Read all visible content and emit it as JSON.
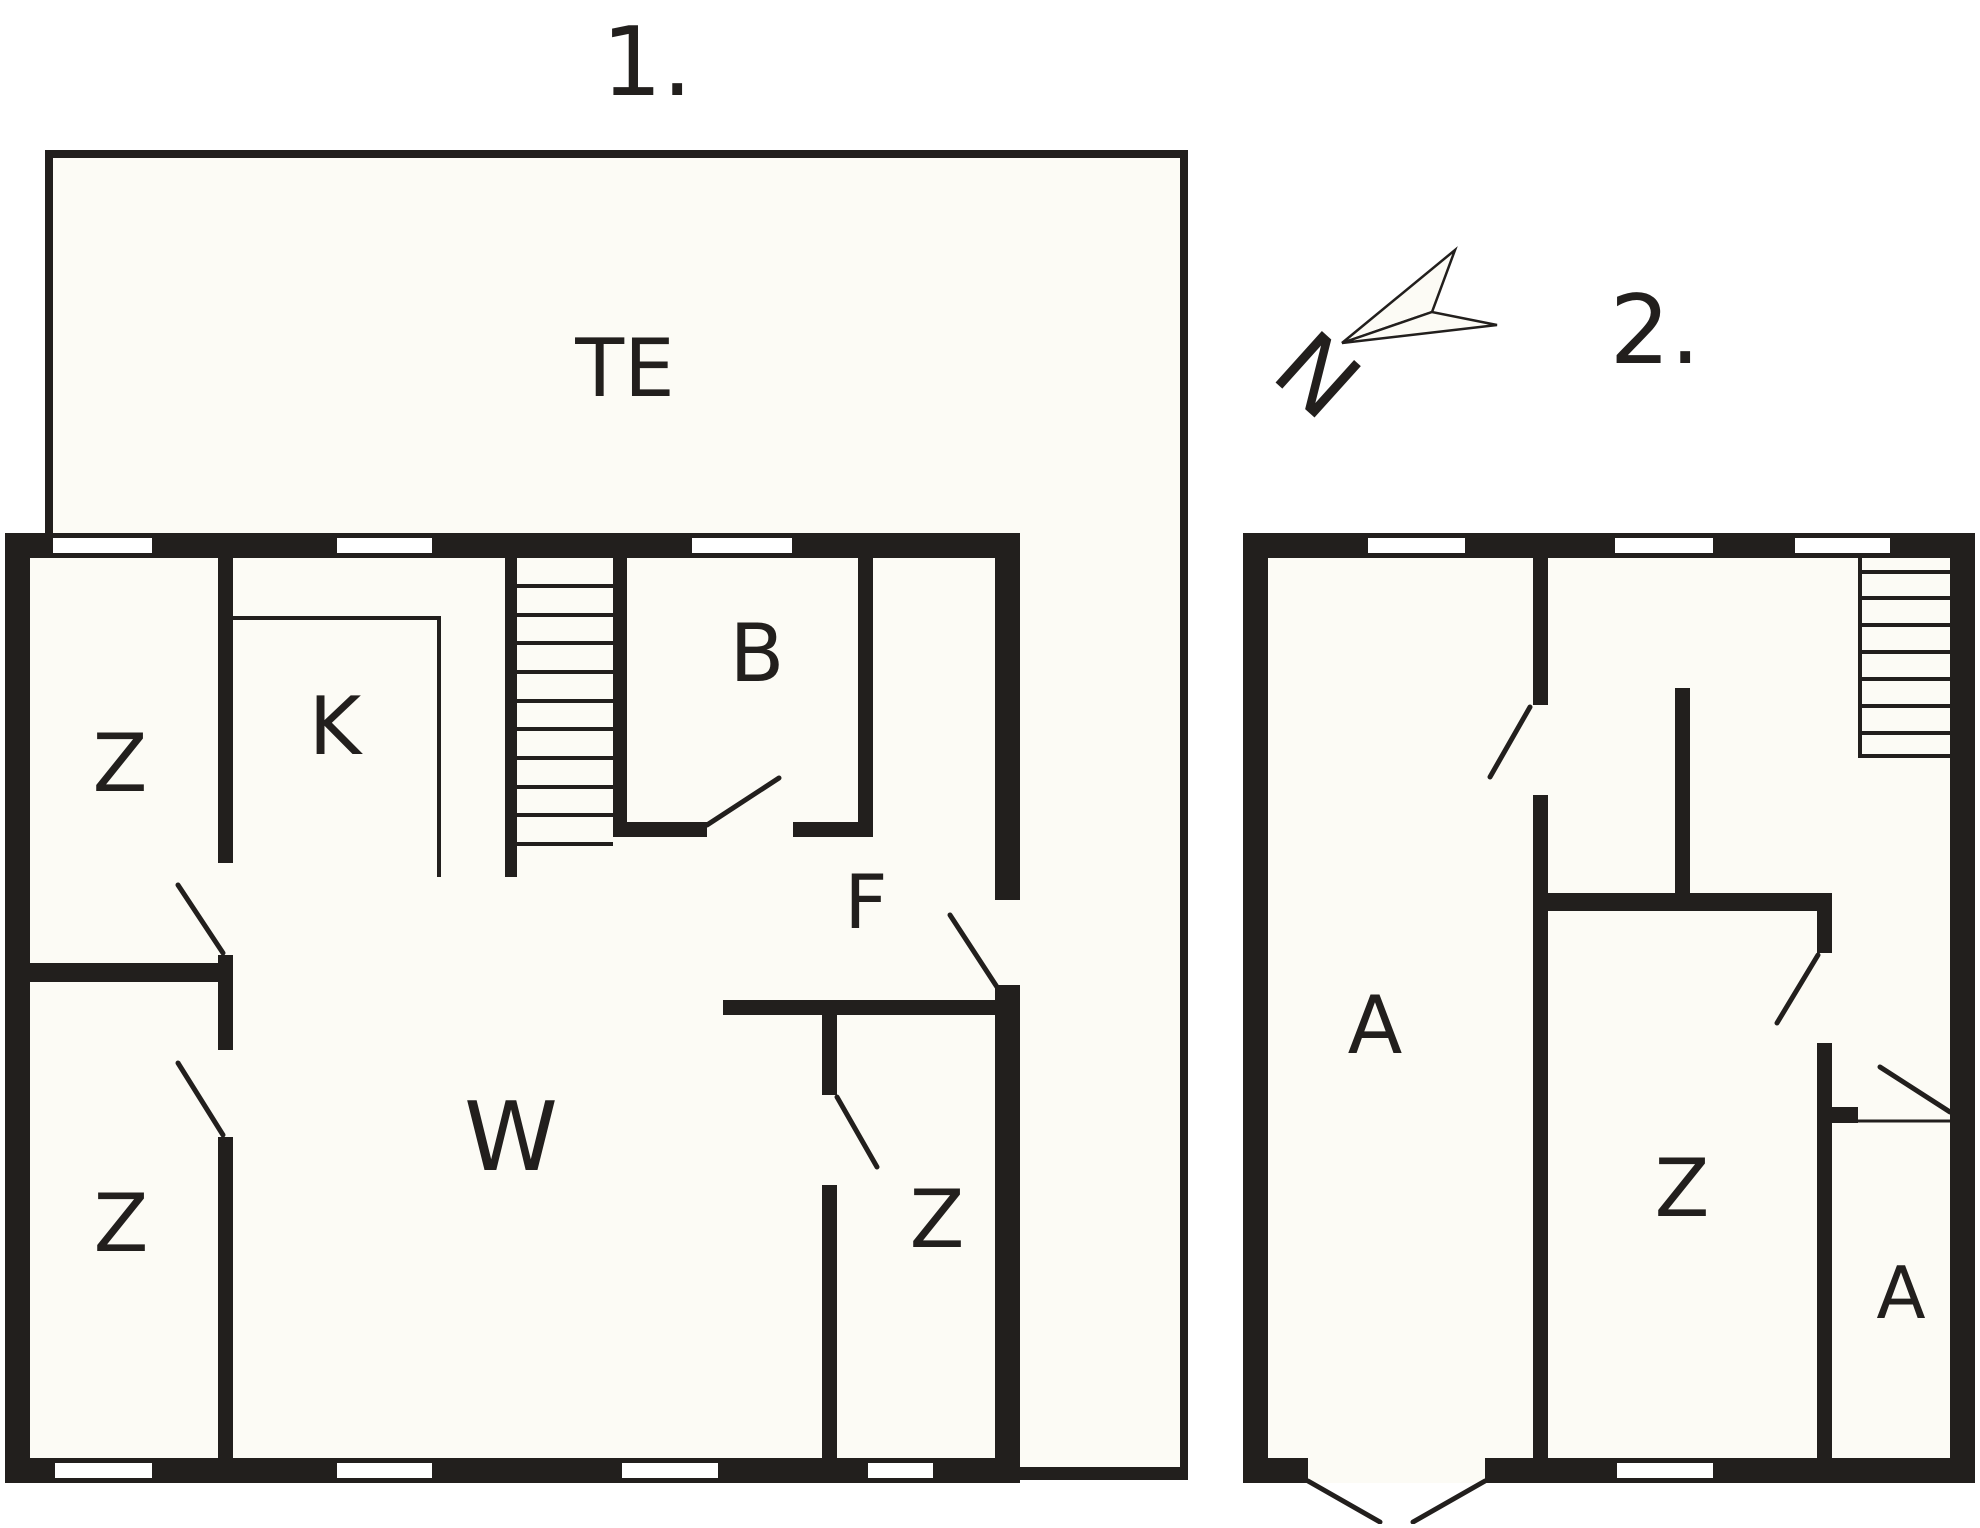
{
  "colors": {
    "wall": "#221f1d",
    "floor": "#fcfbf5",
    "background": "#ffffff",
    "window": "#ffffff"
  },
  "compass": {
    "letter": "N"
  },
  "floor1": {
    "title": "1.",
    "terrace_label": "TE",
    "rooms": [
      {
        "id": "z-top-left",
        "label": "Z"
      },
      {
        "id": "kitchen",
        "label": "K"
      },
      {
        "id": "bathroom",
        "label": "B"
      },
      {
        "id": "hall",
        "label": "F"
      },
      {
        "id": "living",
        "label": "W"
      },
      {
        "id": "z-bottom-left",
        "label": "Z"
      },
      {
        "id": "z-bottom-right",
        "label": "Z"
      }
    ]
  },
  "floor2": {
    "title": "2.",
    "rooms": [
      {
        "id": "a-left",
        "label": "A"
      },
      {
        "id": "z-middle",
        "label": "Z"
      },
      {
        "id": "a-bottom-right",
        "label": "A"
      }
    ]
  }
}
